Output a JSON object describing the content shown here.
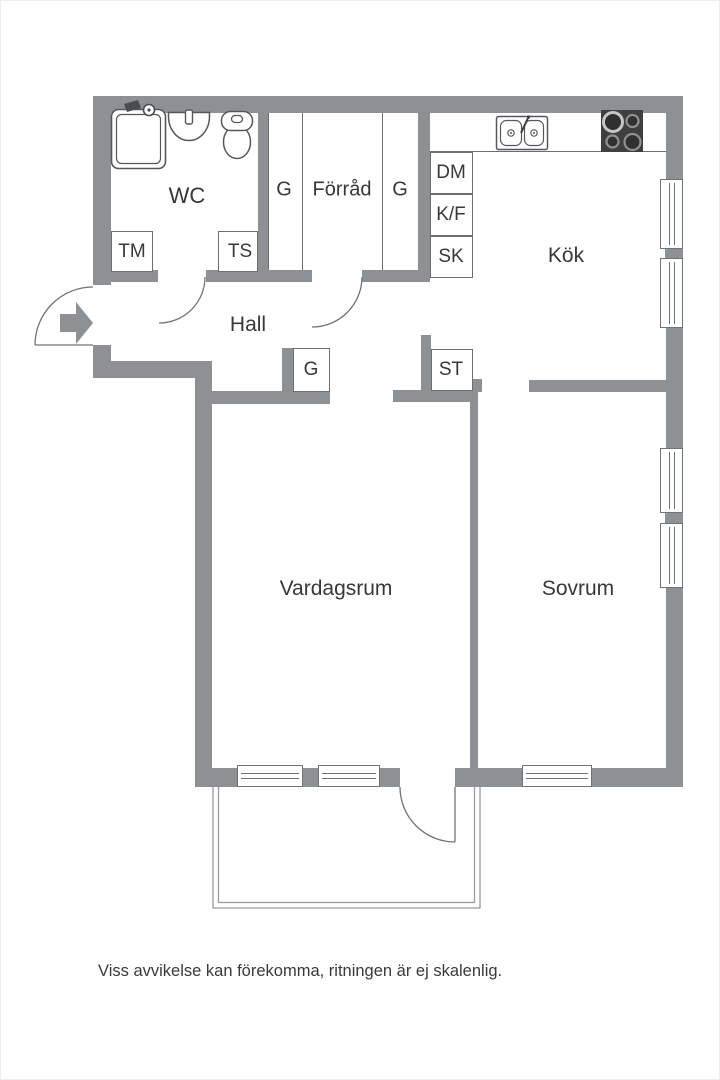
{
  "plan": {
    "rooms": {
      "wc": "WC",
      "forrad": "Förråd",
      "kok": "Kök",
      "hall": "Hall",
      "vardagsrum": "Vardagsrum",
      "sovrum": "Sovrum"
    },
    "units": {
      "tm": "TM",
      "ts": "TS",
      "g_left": "G",
      "g_right": "G",
      "g_hall": "G",
      "st": "ST",
      "dm": "DM",
      "kf": "K/F",
      "sk": "SK"
    },
    "disclaimer": "Viss avvikelse kan förekomma, ritningen är ej skalenlig.",
    "icons": {
      "entrance": "entrance-arrow",
      "shower": "shower",
      "washbasin": "washbasin",
      "toilet": "toilet",
      "kitchen_sink": "double-sink",
      "stove": "stove-4-burners",
      "windows": "window",
      "doors": "door-swing-arc",
      "balcony": "balcony-outline"
    },
    "colors": {
      "wall": "#8d9193",
      "outline": "#6a6f71",
      "text": "#383838",
      "stove": "#3f3f3f",
      "background": "#ffffff"
    }
  }
}
